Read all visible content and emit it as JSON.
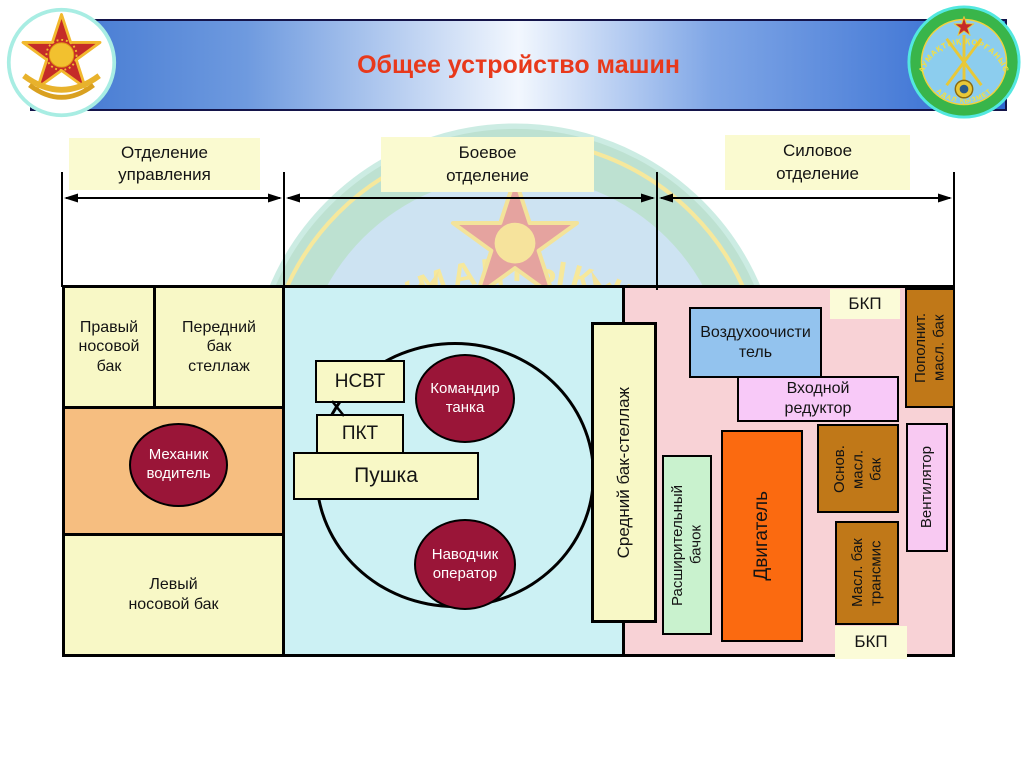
{
  "header": {
    "title": "Общее устройство машин",
    "icons": {
      "left_emblem": "military-star-emblem",
      "right_emblem": "territorial-defense-brigade-round-emblem",
      "watermark": "brigade-emblem-watermark"
    }
  },
  "labels": {
    "control": "Отделение управления",
    "combat": "Боевое отделение",
    "power": "Силовое отделение"
  },
  "control": {
    "right_bow_tank": "Правый носовой бак",
    "front_tank_rack": "Передний бак стеллаж",
    "driver": "Механик водитель",
    "left_bow_tank": "Левый носовой бак"
  },
  "combat": {
    "nsvt": "НСВТ",
    "pkt": "ПКТ",
    "gun": "Пушка",
    "commander": "Командир танка",
    "gunner": "Наводчик оператор",
    "middle_rack": "Средний бак-стеллаж"
  },
  "power": {
    "bkp_top": "БКП",
    "air_cleaner": "Воздухоочиститель",
    "input_reducer": "Входной редуктор",
    "refill_oil": "Пополнит. масл. бак",
    "main_oil": "Основ. масл. бак",
    "trans_oil": "Масл. бак трансмис",
    "fan": "Вентилятор",
    "expansion": "Расширительный бачок",
    "engine": "Двигатель",
    "bkp_bottom": "БКП"
  },
  "watermark": {
    "arc_text": "СЫНЫҢ АУМАҚТЫҚ ҚОРҒАНЫС"
  },
  "emblem_right": {
    "top_text": "АУМАҚТЫҚ ҚОРҒАНЫС",
    "bottom_text": "АДАЛ ҚЫЗМЕТ"
  },
  "colors": {
    "banner_blue": "#3D74D0",
    "title_red": "#E8391B",
    "cream": "#F8F8C6",
    "light_orange_band": "#F6BE80",
    "dark_red_circle": "#9A1538",
    "light_cyan": "#CCF1F4",
    "light_pink": "#F8D2D6",
    "air_cleaner_blue": "#93C3EE",
    "reducer_violet": "#F8C9F8",
    "expansion_green": "#C9F2CE",
    "oil_tank_brown": "#C07818",
    "engine_orange": "#FB6A10"
  }
}
